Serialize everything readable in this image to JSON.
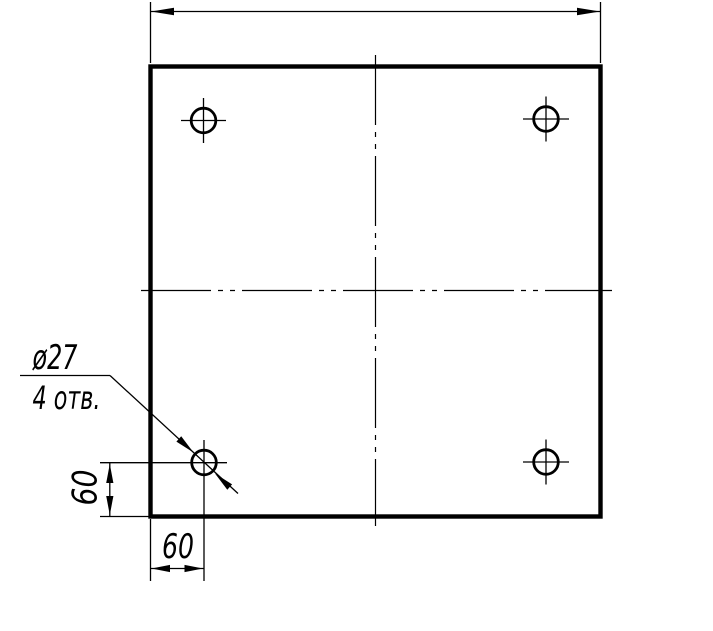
{
  "drawing": {
    "kind": "technical-drawing",
    "description": "Square plate with four drilled holes",
    "colors": {
      "background": "#ffffff",
      "line": "#000000"
    },
    "plate": {
      "shape": "square",
      "holes_count": 4,
      "hole_diameter": 27
    },
    "leader": {
      "diameter_label": "ø27",
      "holes_note": "4 отв."
    },
    "dims": {
      "vertical_offset": "60",
      "horizontal_offset": "60"
    }
  }
}
